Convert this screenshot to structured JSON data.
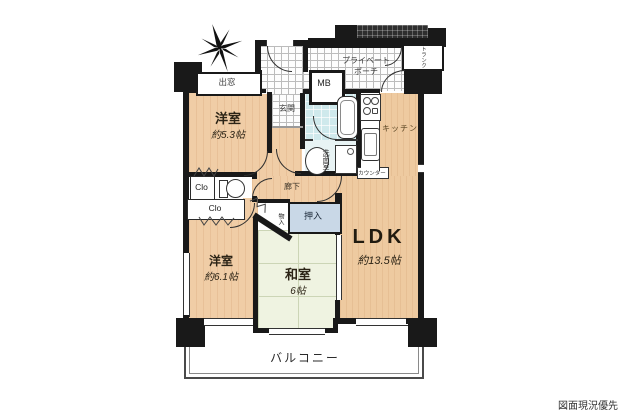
{
  "title": "マンション間取り図",
  "note": {
    "disclaimer": "図面現況優先"
  },
  "labels": {
    "bay_window": "出窓",
    "entrance": "玄関",
    "porch_line1": "プライベート",
    "porch_line2": "ポーチ",
    "meter_box": "MB",
    "trunk": "トランク",
    "kitchen": "キッチン",
    "washroom": "洗面室",
    "counter": "カウンター",
    "hallway": "廊下",
    "closet_upper": "Clo",
    "closet_lower": "Clo",
    "storage": "物入",
    "oshiire": "押入",
    "balcony": "バルコニー"
  },
  "rooms": {
    "western1": {
      "name": "洋室",
      "size": "約5.3帖"
    },
    "western2": {
      "name": "洋室",
      "size": "約6.1帖"
    },
    "japanese": {
      "name": "和室",
      "size": "6帖"
    },
    "ldk": {
      "name": "LDK",
      "size": "約13.5帖"
    }
  },
  "icons": {
    "compass": "compass-north-star"
  },
  "colors": {
    "wall": "#191919",
    "wood_floor": "#f0cda6",
    "tatami": "#eff3e1",
    "bathroom": "#cfe9ec",
    "oshiire_fill": "#c9d8e7",
    "tile_line": "#bcbcbc",
    "background": "#ffffff"
  }
}
